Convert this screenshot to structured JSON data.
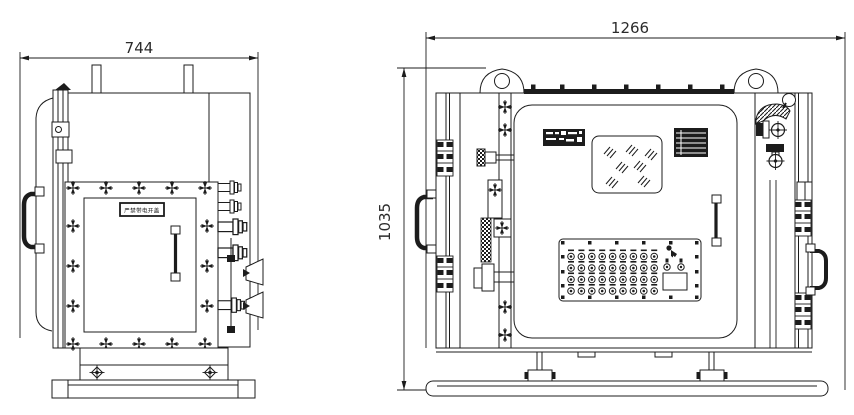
{
  "side_view": {
    "width_dimension": "744",
    "door_warning_label": "严禁带电开盖"
  },
  "front_view": {
    "width_dimension": "1266",
    "height_dimension": "1035",
    "button_panel": {
      "rows": 4,
      "columns": 9,
      "aux_buttons": 2
    }
  },
  "colors": {
    "line": "#1c1c1c",
    "background": "#ffffff"
  }
}
